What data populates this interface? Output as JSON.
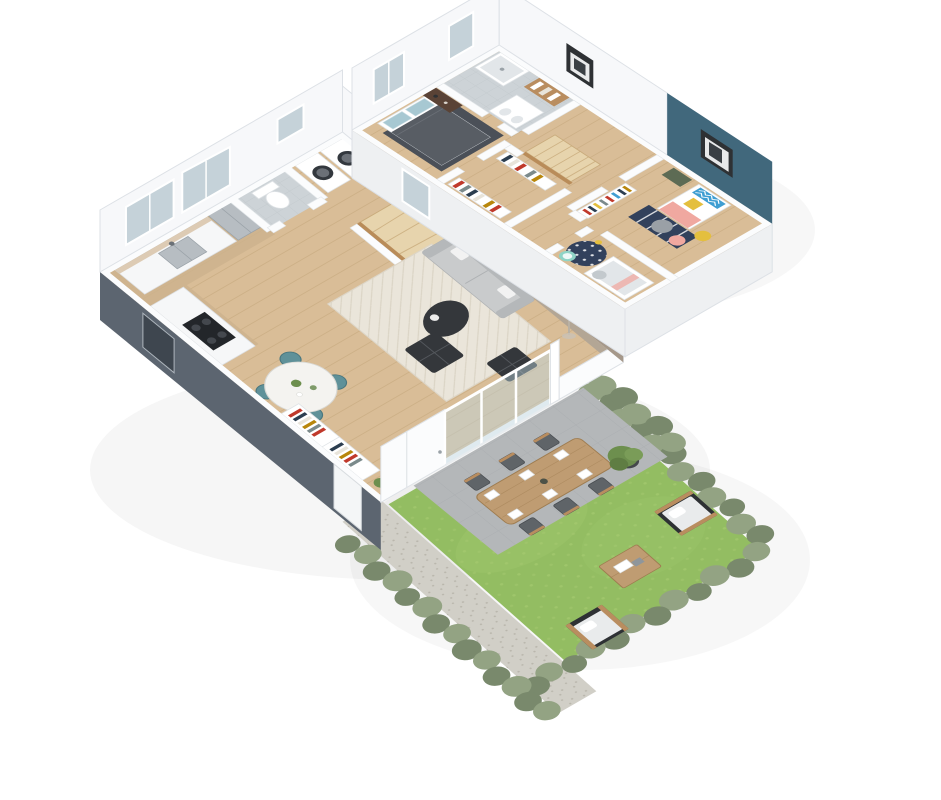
{
  "scene": {
    "kind": "isometric-3d-floorplan-render",
    "levels": [
      "upper-floor",
      "ground-floor",
      "garden"
    ]
  },
  "colors": {
    "bg": "#ffffff",
    "wood": "#d9bd97",
    "wood-kitchen": "#cdb38d",
    "wood-line": "#c2a377",
    "stair-wood": "#e7d4ad",
    "stair-edge": "#c9ab7c",
    "rail-wood": "#b98c59",
    "wall-face": "#f7f8fa",
    "wall-face2": "#eef0f2",
    "wall-edge": "#dde1e6",
    "white-wall": "#fbfcfd",
    "wall-strip-edge": "#e3e7ea",
    "slate": "#5c6570",
    "slate-dark": "#3e464f",
    "window": "#c5d2d9",
    "glass": "#bcd4de",
    "taupe": "#a5988a",
    "taupe-top": "#b3a695",
    "niche": "#4b463f",
    "teal": "#41687c",
    "tile": "#cdd3d7",
    "tile-light": "#e2e6e9",
    "tile-line": "#bcc3c8",
    "rug": "#eae5da",
    "rug-line": "#d9d2c2",
    "rug-edge": "#ddd6c8",
    "rug-dark": "#4b5058",
    "sofa": "#c9cbcc",
    "sofa-dark": "#b5b8ba",
    "sofa-edge": "#aeb1b3",
    "lamp": "#cfc5b4",
    "table-dark": "#34373b",
    "chair-teal": "#5f9199",
    "chair-teal-dark": "#49767e",
    "marble": "#f4f3f0",
    "cab": "#f6f7f8",
    "cab-edge": "#dcdfe2",
    "counter-wood": "#c9a87c",
    "steel": "#b7bdc2",
    "hob": "#23262a",
    "drum": "#33383e",
    "walnut": "#5a4336",
    "blanket": "#585d64",
    "pillow-blue": "#a7c8d2",
    "kid-blue": "#3f9ed2",
    "yellow": "#e4bf3e",
    "pink": "#f0a8a0",
    "navy": "#32415c",
    "mint": "#8fd4c6",
    "shelf-wood": "#b98d5f",
    "lawn": "#93bd62",
    "lawn-light": "#a6cb72",
    "hedge": "#93a383",
    "hedge-dark": "#79896c",
    "path": "#d1cfc7",
    "gravel-dot": "#b9b6ac",
    "paver": "#b4b7b9",
    "paver-line": "#a3a7aa",
    "outdoor-wood": "#bf9c72",
    "outdoor-wood-dark": "#9e7c50",
    "chair-dark": "#5f6468",
    "frame-dark": "#2e3134",
    "cushion": "#e9ebec",
    "pot-dark": "#45484c",
    "plant-green": "#6d8f4e"
  }
}
